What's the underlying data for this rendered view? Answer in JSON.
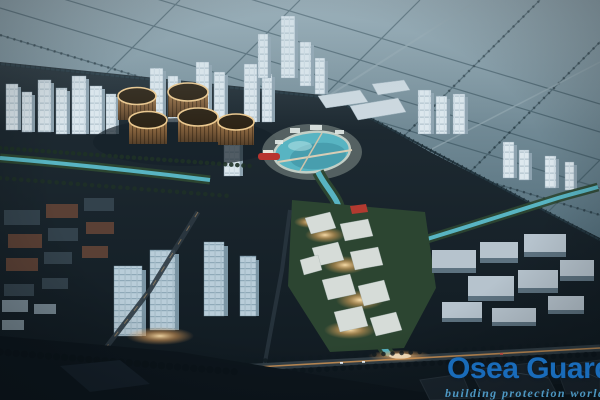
{
  "image": {
    "subject": "aerial-dusk-rendering-of-city-masterplan",
    "features": [
      "farmland-grid-background",
      "highrise-skyline",
      "five-drum-towers",
      "central-lagoon",
      "winding-river",
      "warm-lit-village",
      "lit-main-road"
    ]
  },
  "watermark": {
    "brand": "Osea Guard",
    "tagline": "building protection world"
  },
  "colors": {
    "brand_blue": "#1a70c2",
    "tagline_blue": "#55a8d8",
    "field_blue": "#7f97a2",
    "water_teal": "#58b4c2",
    "park_green": "#2d4732",
    "glow_warm": "#f6bb74",
    "building_light": "#dde8ee",
    "drum_amber": "#8a6844",
    "ground_dark": "#18242c"
  }
}
